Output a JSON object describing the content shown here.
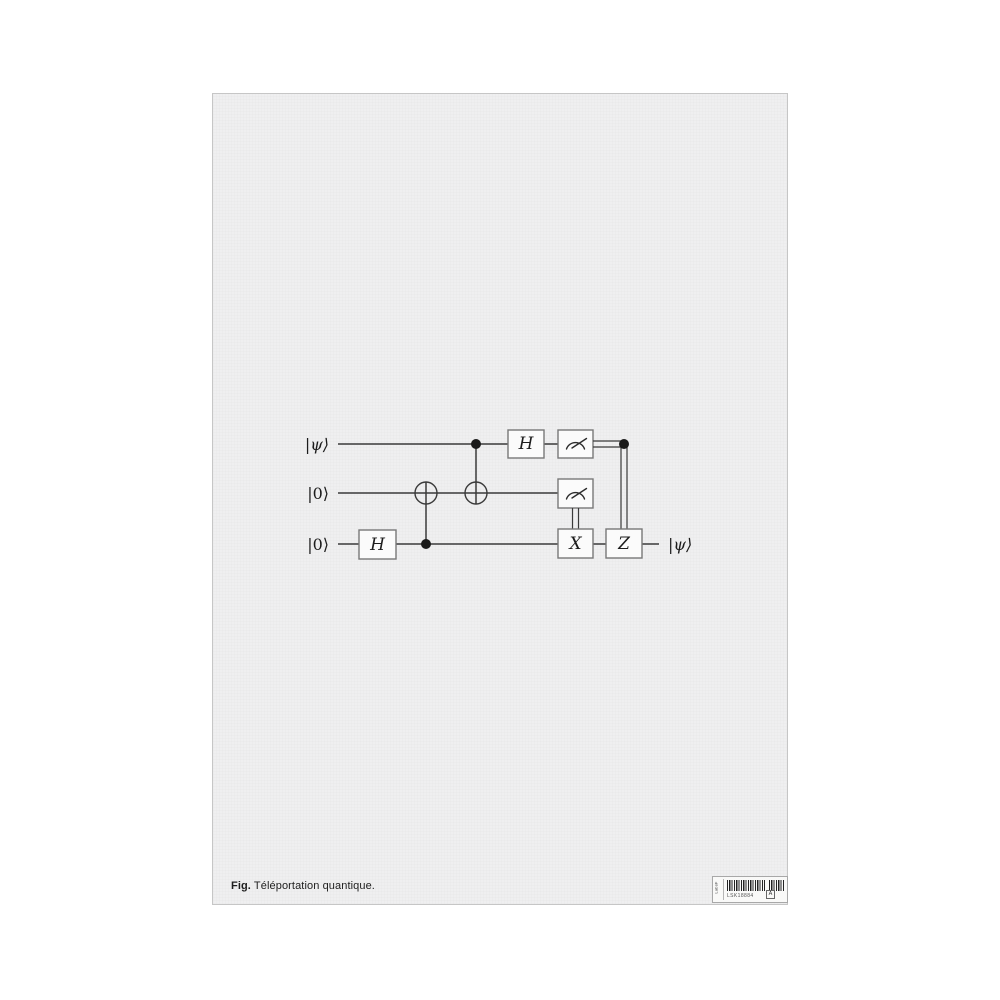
{
  "colors": {
    "paper": "#efeff0",
    "background": "#ffffff",
    "ink": "#3a3a3a",
    "box_stroke": "#787878"
  },
  "circuit": {
    "qubits": [
      "|ψ⟩",
      "|0⟩",
      "|0⟩"
    ],
    "output_label": "|ψ⟩",
    "gates": {
      "h_bottom": "H",
      "h_top": "H",
      "x_gate": "X",
      "z_gate": "Z"
    }
  },
  "caption": {
    "prefix": "Fig.",
    "text": "Téléportation quantique."
  },
  "sticker": {
    "side_text": "LabsF",
    "code": "LSK18884",
    "grade": "A"
  }
}
